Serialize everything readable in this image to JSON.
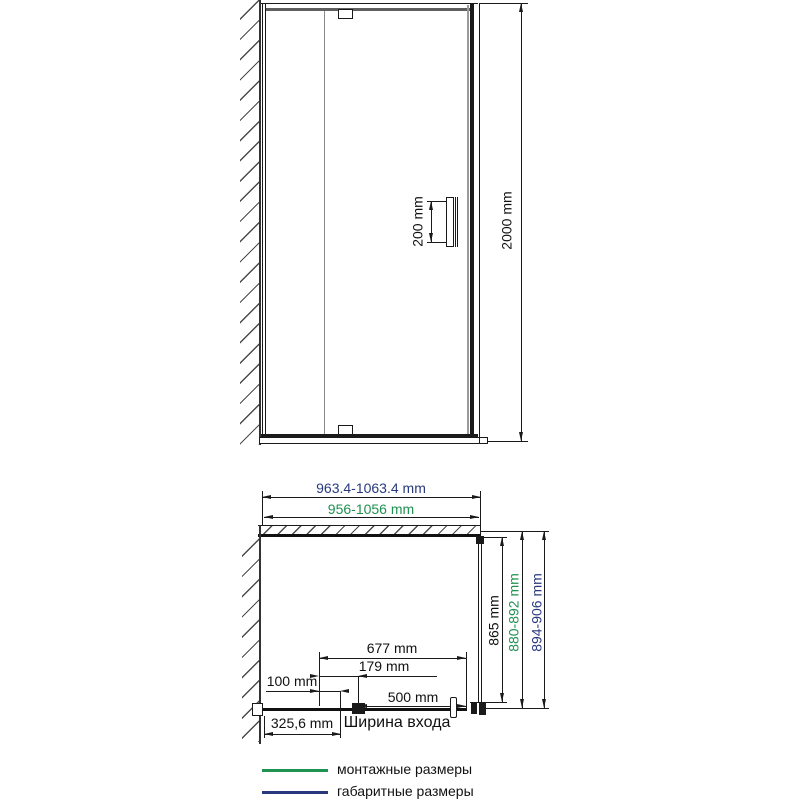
{
  "colors": {
    "line": "#1a1a1a",
    "green_mounting": "#1f9150",
    "navy_overall": "#28397e"
  },
  "front_view": {
    "handle_height": "200 mm",
    "total_height": "2000 mm"
  },
  "plan_view": {
    "overall_width": "963.4-1063.4 mm",
    "mounting_width": "956-1056 mm",
    "glass_depth": "865 mm",
    "mounting_depth": "880-892 mm",
    "overall_depth": "894-906 mm",
    "door_glass_width": "677 mm",
    "hinge_offset": "179 mm",
    "wall_profile_adjust": "100 mm",
    "entrance_width": "500 mm",
    "entrance_label": "Ширина входа",
    "fixed_panel_width": "325,6 mm"
  },
  "legend": {
    "items": [
      {
        "label": "монтажные размеры",
        "color": "#1f9150"
      },
      {
        "label": "габаритные размеры",
        "color": "#28397e"
      }
    ]
  }
}
